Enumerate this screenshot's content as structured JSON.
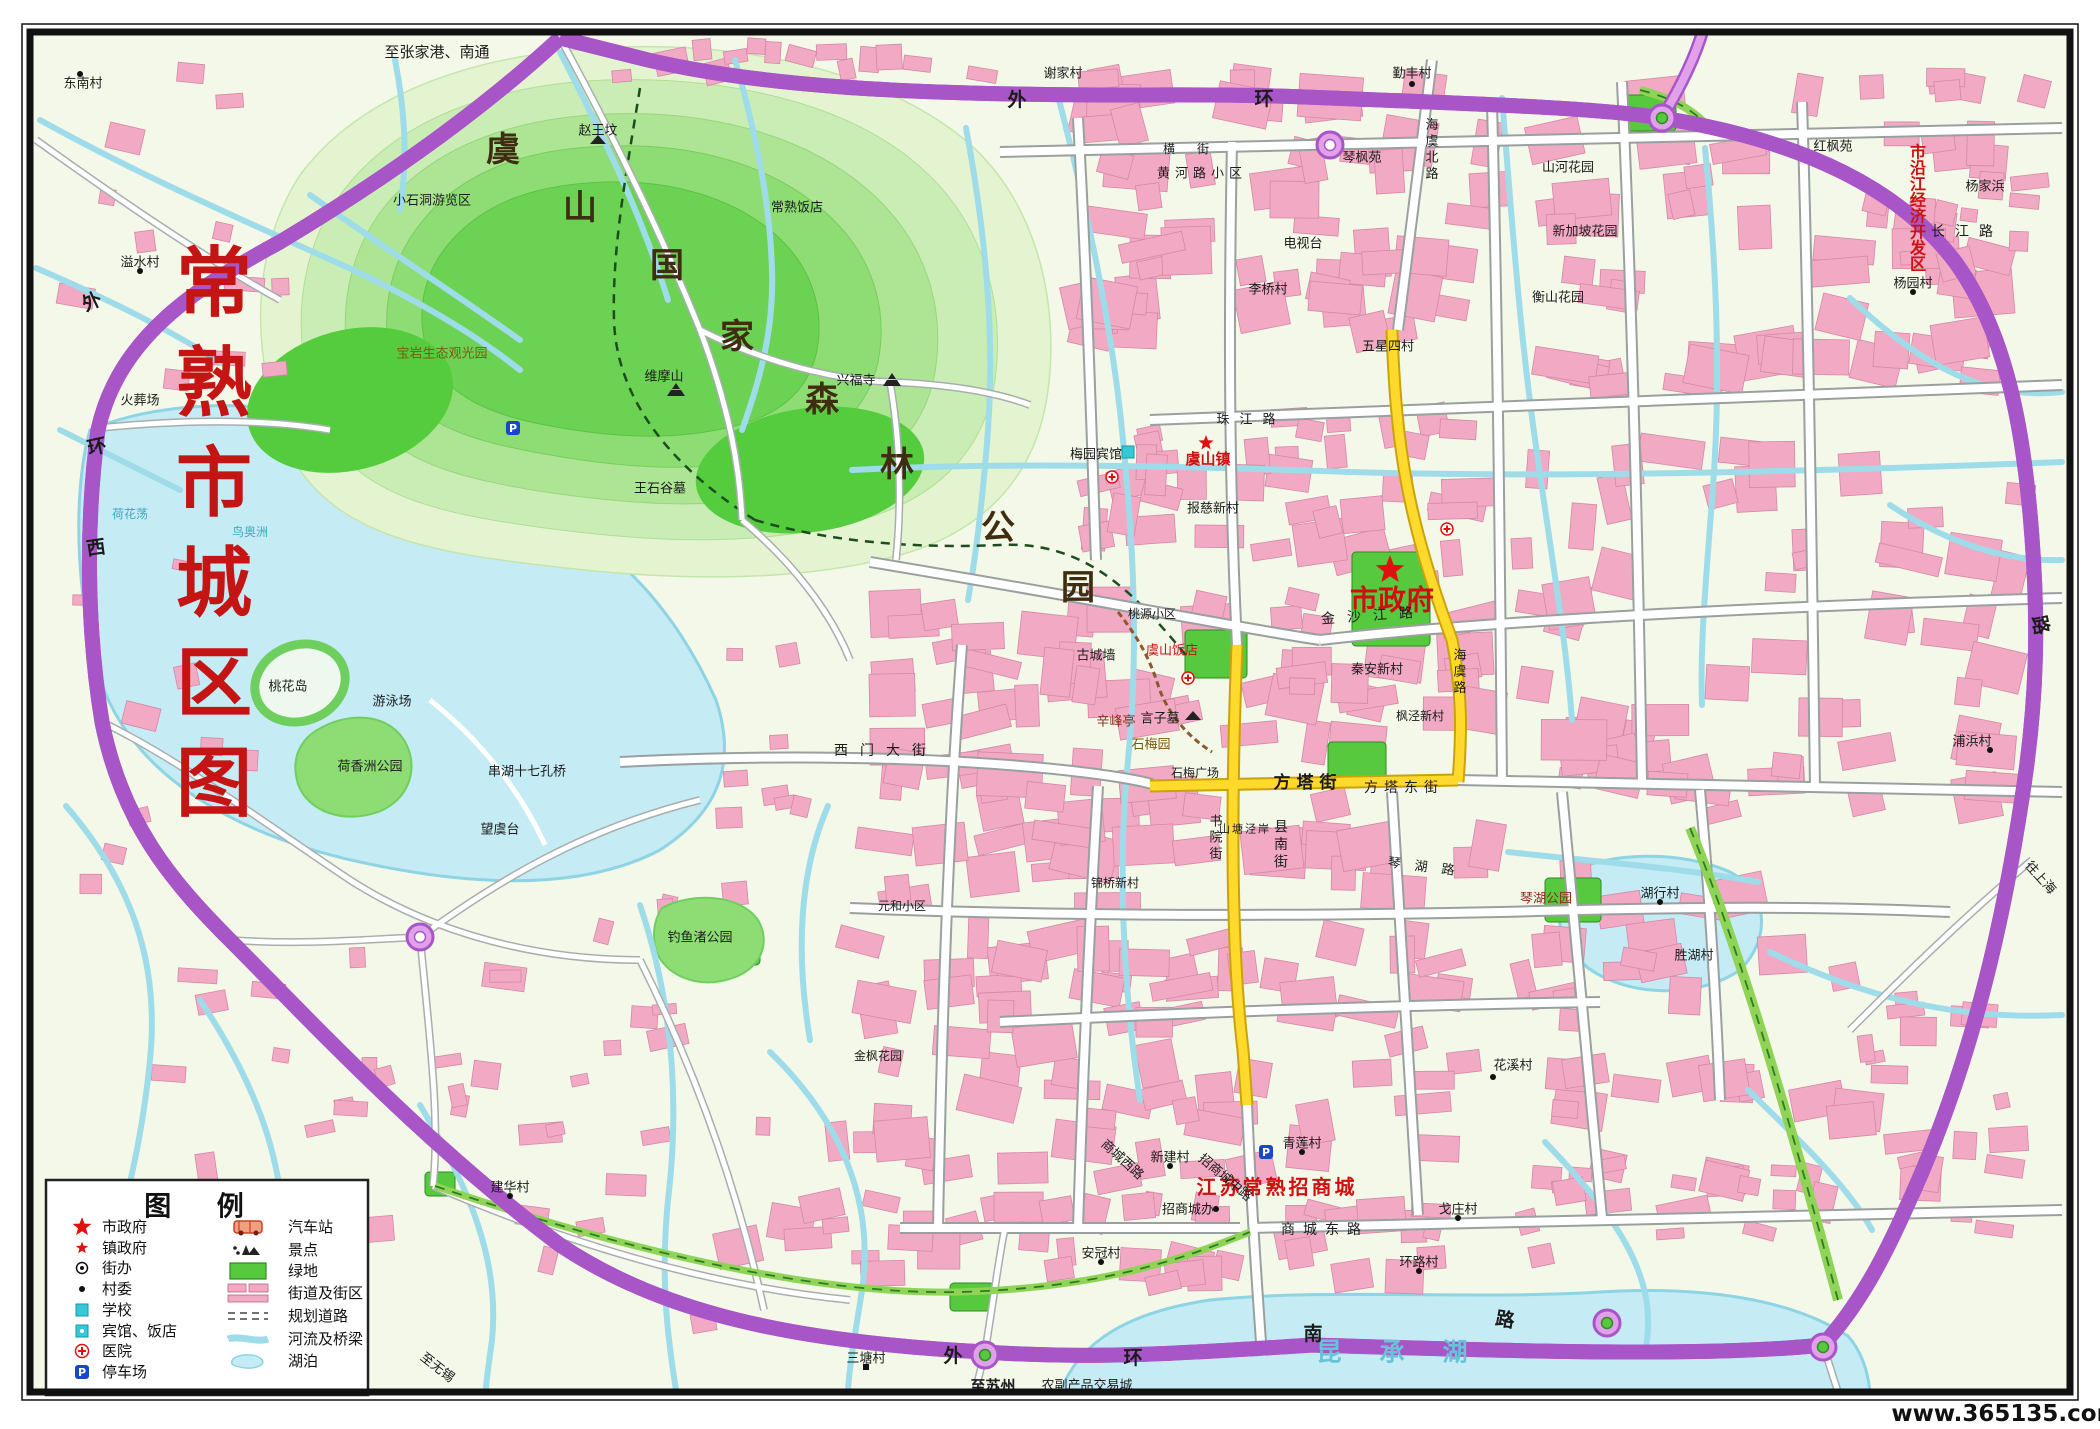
{
  "watermark": "www.365135.com",
  "map_title": {
    "text": "常熟市城区图",
    "color": "#c41414"
  },
  "zone_label": {
    "text": "市沿江经济开发区",
    "color": "#cc1111"
  },
  "lake_names": {
    "west_islets": [
      "鸟奥洲",
      "荷花荡"
    ],
    "southeast": "昆承湖"
  },
  "park_name": {
    "text": "虞山国家森林公园",
    "chars": [
      {
        "t": "虞",
        "x": 503,
        "y": 150
      },
      {
        "t": "山",
        "x": 580,
        "y": 208
      },
      {
        "t": "国",
        "x": 667,
        "y": 266
      },
      {
        "t": "家",
        "x": 737,
        "y": 337
      },
      {
        "t": "森",
        "x": 822,
        "y": 400
      },
      {
        "t": "林",
        "x": 897,
        "y": 465
      },
      {
        "t": "公",
        "x": 998,
        "y": 528
      },
      {
        "t": "园",
        "x": 1078,
        "y": 588
      }
    ]
  },
  "ring_road_chars": [
    {
      "t": "外",
      "x": 1017,
      "y": 100
    },
    {
      "t": "环",
      "x": 1264,
      "y": 99
    },
    {
      "t": "外",
      "x": 92,
      "y": 302,
      "r": -25
    },
    {
      "t": "环",
      "x": 97,
      "y": 447,
      "r": -12
    },
    {
      "t": "西",
      "x": 96,
      "y": 548,
      "r": -8
    },
    {
      "t": "外",
      "x": 953,
      "y": 1356
    },
    {
      "t": "环",
      "x": 1133,
      "y": 1358
    },
    {
      "t": "南",
      "x": 1313,
      "y": 1334
    },
    {
      "t": "路",
      "x": 1505,
      "y": 1320,
      "r": 10
    },
    {
      "t": "路",
      "x": 2040,
      "y": 625,
      "r": 78
    }
  ],
  "labels": [
    {
      "t": "常熟市城区图",
      "x": 214,
      "y": 533,
      "s": 76,
      "c": "#c41414",
      "b": 1,
      "v": 1,
      "sp": 100,
      "serif": 1
    },
    {
      "t": "市沿江经济开发区",
      "x": 1918,
      "y": 208,
      "s": 16,
      "c": "#cc1111",
      "b": 1,
      "v": 1,
      "sp": 16
    },
    {
      "t": "市政府",
      "x": 1392,
      "y": 600,
      "s": 28,
      "c": "#d01010",
      "b": 1
    },
    {
      "t": "虞山镇",
      "x": 1208,
      "y": 459,
      "s": 15,
      "c": "#d01010",
      "b": 1
    },
    {
      "t": "虞山饭店",
      "x": 1172,
      "y": 651,
      "s": 13,
      "c": "#d01010"
    },
    {
      "t": "江苏常熟招商城",
      "x": 1277,
      "y": 1187,
      "s": 20,
      "c": "#d01010",
      "b": 1,
      "ls": 3
    },
    {
      "t": "辛峰亭",
      "x": 1116,
      "y": 722,
      "s": 13,
      "c": "#8a2b1a"
    },
    {
      "t": "琴湖公园",
      "x": 1546,
      "y": 899,
      "s": 13,
      "c": "#8a2b1a"
    },
    {
      "t": "石梅园",
      "x": 1151,
      "y": 745,
      "s": 13,
      "c": "#7a5a10"
    },
    {
      "t": "宝岩生态观光园",
      "x": 442,
      "y": 354,
      "s": 13,
      "c": "#7a5a10"
    },
    {
      "t": "昆承湖",
      "x": 1411,
      "y": 1352,
      "s": 25,
      "c": "#67c3d8",
      "ls": 38,
      "b": 1
    },
    {
      "t": "鸟奥洲",
      "x": 250,
      "y": 532,
      "s": 12,
      "c": "#3fa8c0"
    },
    {
      "t": "荷花荡",
      "x": 130,
      "y": 514,
      "s": 12,
      "c": "#3fa8c0"
    },
    {
      "t": "方塔街",
      "x": 1308,
      "y": 783,
      "s": 17,
      "ls": 6,
      "b": 1
    },
    {
      "t": "方塔东街",
      "x": 1404,
      "y": 788,
      "s": 14,
      "ls": 6
    },
    {
      "t": "金沙江路",
      "x": 1373,
      "y": 616,
      "s": 14,
      "ls": 12,
      "r": -4
    },
    {
      "t": "西门大街",
      "x": 886,
      "y": 751,
      "s": 14,
      "ls": 12
    },
    {
      "t": "商城东路",
      "x": 1325,
      "y": 1230,
      "s": 14,
      "ls": 8
    },
    {
      "t": "商城西路",
      "x": 1122,
      "y": 1160,
      "s": 13,
      "r": 42
    },
    {
      "t": "招商城中路",
      "x": 1225,
      "y": 1178,
      "s": 13,
      "r": 40
    },
    {
      "t": "县南街",
      "x": 1281,
      "y": 845,
      "s": 14,
      "v": 1
    },
    {
      "t": "书院街",
      "x": 1216,
      "y": 838,
      "s": 13,
      "v": 1
    },
    {
      "t": "海虞北路",
      "x": 1432,
      "y": 150,
      "s": 13,
      "v": 1
    },
    {
      "t": "海虞路",
      "x": 1460,
      "y": 672,
      "s": 13,
      "v": 1
    },
    {
      "t": "珠江路",
      "x": 1251,
      "y": 420,
      "s": 13,
      "ls": 10
    },
    {
      "t": "长江路",
      "x": 1967,
      "y": 232,
      "s": 14,
      "ls": 10
    },
    {
      "t": "黄河路小区",
      "x": 1202,
      "y": 174,
      "s": 13,
      "ls": 5
    },
    {
      "t": "横街",
      "x": 1197,
      "y": 149,
      "s": 12,
      "ls": 22
    },
    {
      "t": "琴湖路",
      "x": 1428,
      "y": 868,
      "s": 13,
      "ls": 14,
      "r": 7
    },
    {
      "t": "山塘泾岸",
      "x": 1245,
      "y": 829,
      "s": 11,
      "ls": 2
    },
    {
      "t": "至张家港、南通",
      "x": 437,
      "y": 52,
      "s": 15
    },
    {
      "t": "至苏州",
      "x": 993,
      "y": 1386,
      "s": 15,
      "b": 1
    },
    {
      "t": "农副产品交易城",
      "x": 1087,
      "y": 1386,
      "s": 13
    },
    {
      "t": "至无锡",
      "x": 437,
      "y": 1368,
      "s": 13,
      "r": 38
    },
    {
      "t": "往上海",
      "x": 2040,
      "y": 878,
      "s": 13,
      "r": 48
    },
    {
      "t": "东南村",
      "x": 83,
      "y": 84,
      "s": 13
    },
    {
      "t": "谢家村",
      "x": 1063,
      "y": 74,
      "s": 13
    },
    {
      "t": "勤丰村",
      "x": 1412,
      "y": 74,
      "s": 13
    },
    {
      "t": "琴枫苑",
      "x": 1362,
      "y": 158,
      "s": 13
    },
    {
      "t": "山河花园",
      "x": 1568,
      "y": 168,
      "s": 13
    },
    {
      "t": "新加坡花园",
      "x": 1585,
      "y": 232,
      "s": 13
    },
    {
      "t": "红枫苑",
      "x": 1833,
      "y": 147,
      "s": 13
    },
    {
      "t": "杨家浜",
      "x": 1985,
      "y": 187,
      "s": 13
    },
    {
      "t": "杨园村",
      "x": 1913,
      "y": 284,
      "s": 13
    },
    {
      "t": "衡山花园",
      "x": 1558,
      "y": 298,
      "s": 13
    },
    {
      "t": "五星四村",
      "x": 1388,
      "y": 347,
      "s": 13
    },
    {
      "t": "电视台",
      "x": 1303,
      "y": 244,
      "s": 13
    },
    {
      "t": "李桥村",
      "x": 1268,
      "y": 290,
      "s": 13
    },
    {
      "t": "常熟饭店",
      "x": 797,
      "y": 208,
      "s": 13
    },
    {
      "t": "梅园宾馆",
      "x": 1096,
      "y": 455,
      "s": 13
    },
    {
      "t": "报慈新村",
      "x": 1213,
      "y": 509,
      "s": 13
    },
    {
      "t": "兴福寺",
      "x": 856,
      "y": 381,
      "s": 13
    },
    {
      "t": "维摩山",
      "x": 664,
      "y": 377,
      "s": 13
    },
    {
      "t": "赵王坟",
      "x": 598,
      "y": 131,
      "s": 13
    },
    {
      "t": "小石洞游览区",
      "x": 432,
      "y": 201,
      "s": 13
    },
    {
      "t": "王石谷墓",
      "x": 660,
      "y": 489,
      "s": 13
    },
    {
      "t": "言子墓",
      "x": 1160,
      "y": 719,
      "s": 13
    },
    {
      "t": "石梅广场",
      "x": 1195,
      "y": 773,
      "s": 12
    },
    {
      "t": "古城墙",
      "x": 1096,
      "y": 656,
      "s": 13
    },
    {
      "t": "桃源小区",
      "x": 1152,
      "y": 614,
      "s": 12
    },
    {
      "t": "秦安新村",
      "x": 1377,
      "y": 670,
      "s": 13
    },
    {
      "t": "枫泾新村",
      "x": 1420,
      "y": 716,
      "s": 12
    },
    {
      "t": "锦桥新村",
      "x": 1115,
      "y": 883,
      "s": 12
    },
    {
      "t": "元和小区",
      "x": 902,
      "y": 906,
      "s": 12
    },
    {
      "t": "金枫花园",
      "x": 878,
      "y": 1056,
      "s": 12
    },
    {
      "t": "湖行村",
      "x": 1660,
      "y": 894,
      "s": 13
    },
    {
      "t": "胜湖村",
      "x": 1694,
      "y": 956,
      "s": 13
    },
    {
      "t": "花溪村",
      "x": 1513,
      "y": 1066,
      "s": 13
    },
    {
      "t": "桃花岛",
      "x": 288,
      "y": 687,
      "s": 13
    },
    {
      "t": "游泳场",
      "x": 392,
      "y": 702,
      "s": 13
    },
    {
      "t": "荷香洲公园",
      "x": 370,
      "y": 767,
      "s": 13
    },
    {
      "t": "串湖十七孔桥",
      "x": 527,
      "y": 772,
      "s": 13
    },
    {
      "t": "望虞台",
      "x": 500,
      "y": 830,
      "s": 13
    },
    {
      "t": "钓鱼渚公园",
      "x": 700,
      "y": 938,
      "s": 13
    },
    {
      "t": "火葬场",
      "x": 140,
      "y": 401,
      "s": 13
    },
    {
      "t": "溢水村",
      "x": 140,
      "y": 263,
      "s": 13
    },
    {
      "t": "新建村",
      "x": 1170,
      "y": 1158,
      "s": 13
    },
    {
      "t": "招商城办",
      "x": 1188,
      "y": 1210,
      "s": 13
    },
    {
      "t": "青莲村",
      "x": 1302,
      "y": 1144,
      "s": 13
    },
    {
      "t": "戈庄村",
      "x": 1458,
      "y": 1210,
      "s": 13
    },
    {
      "t": "环路村",
      "x": 1419,
      "y": 1263,
      "s": 13
    },
    {
      "t": "安冠村",
      "x": 1101,
      "y": 1254,
      "s": 13
    },
    {
      "t": "三塘村",
      "x": 866,
      "y": 1359,
      "s": 13
    },
    {
      "t": "建华村",
      "x": 510,
      "y": 1188,
      "s": 13
    },
    {
      "t": "浦浜村",
      "x": 1972,
      "y": 742,
      "s": 13
    }
  ],
  "icons": {
    "stars": [
      {
        "x": 1390,
        "y": 570,
        "s": 15
      },
      {
        "x": 1206,
        "y": 443,
        "s": 8
      }
    ],
    "hospitals": [
      [
        1188,
        678
      ],
      [
        1112,
        477
      ],
      [
        1447,
        529
      ]
    ],
    "parking": [
      [
        513,
        428
      ],
      [
        1266,
        1152
      ]
    ],
    "hotels": [
      [
        1128,
        452
      ]
    ],
    "temples": [
      [
        892,
        381
      ],
      [
        676,
        391
      ]
    ],
    "mounds": [
      [
        1193,
        716
      ],
      [
        598,
        140
      ]
    ],
    "dots": [
      [
        80,
        74
      ],
      [
        1412,
        84
      ],
      [
        1913,
        292
      ],
      [
        1660,
        902
      ],
      [
        1493,
        1077
      ],
      [
        1170,
        1166
      ],
      [
        1302,
        1152
      ],
      [
        1458,
        1218
      ],
      [
        1419,
        1271
      ],
      [
        1101,
        1262
      ],
      [
        510,
        1196
      ],
      [
        140,
        271
      ],
      [
        1990,
        750
      ],
      [
        1216,
        1209
      ]
    ],
    "squares": [
      [
        866,
        1367
      ]
    ]
  },
  "legend": {
    "title": "图 例",
    "left": [
      {
        "label": "市政府",
        "sym": "star-lg"
      },
      {
        "label": "镇政府",
        "sym": "star-sm"
      },
      {
        "label": "街办",
        "sym": "circle-dot"
      },
      {
        "label": "村委",
        "sym": "dot"
      },
      {
        "label": "学校",
        "sym": "school"
      },
      {
        "label": "宾馆、饭店",
        "sym": "hotel"
      },
      {
        "label": "医院",
        "sym": "hospital"
      },
      {
        "label": "停车场",
        "sym": "parking"
      }
    ],
    "right": [
      {
        "label": "汽车站",
        "sym": "bus"
      },
      {
        "label": "景点",
        "sym": "scenic"
      },
      {
        "label": "绿地",
        "sym": "green"
      },
      {
        "label": "街道及街区",
        "sym": "street"
      },
      {
        "label": "规划道路",
        "sym": "planned"
      },
      {
        "label": "河流及桥梁",
        "sym": "river"
      },
      {
        "label": "湖泊",
        "sym": "lake"
      }
    ]
  },
  "colors": {
    "urban_block": "#f2a9c4",
    "ring_road": "#e2a0ea",
    "highlight_road": "#ffd92b",
    "water": "#c5ebf5",
    "park_green": "#6bd253",
    "title_red": "#c41414"
  }
}
